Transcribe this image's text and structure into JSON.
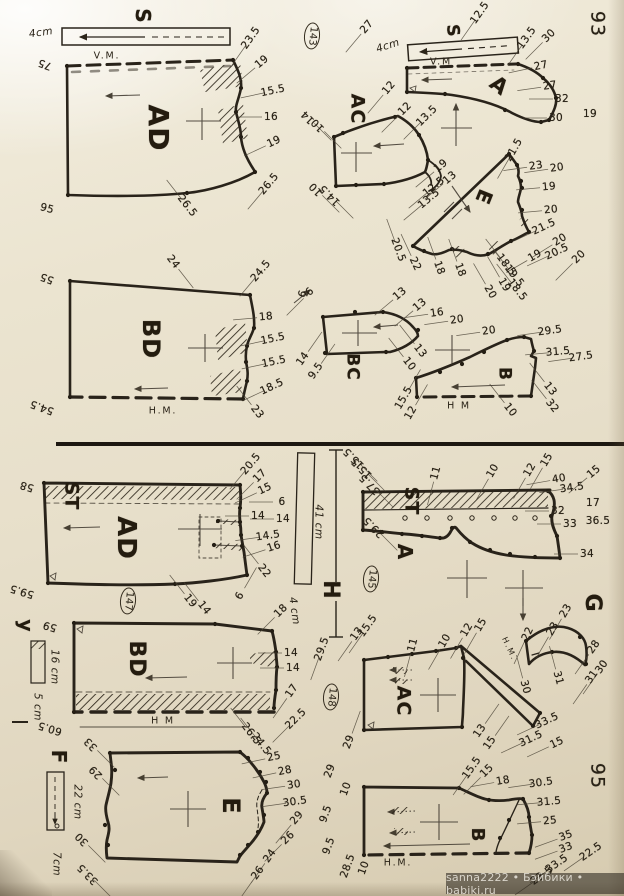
{
  "page": {
    "watermark": "sanna2222 • Бэйбики • babiki.ru",
    "ink_color": "#29231a",
    "paper_color": "#e9e2cf"
  },
  "labels": [
    {
      "t": "S",
      "x": 143,
      "y": 16,
      "r": 90,
      "s": 20,
      "c": "big",
      "n": "label-s-left"
    },
    {
      "t": "S",
      "x": 452,
      "y": 31,
      "r": 85,
      "s": 17,
      "c": "big",
      "n": "label-s-right"
    },
    {
      "t": "AD",
      "x": 158,
      "y": 128,
      "r": 90,
      "s": 28,
      "c": "big",
      "n": "piece-ad-top"
    },
    {
      "t": "BD",
      "x": 151,
      "y": 339,
      "r": 90,
      "s": 24,
      "c": "big",
      "n": "piece-bd-top"
    },
    {
      "t": "AC",
      "x": 357,
      "y": 109,
      "r": 90,
      "s": 19,
      "c": "big",
      "n": "piece-ac-top"
    },
    {
      "t": "A",
      "x": 499,
      "y": 86,
      "r": 38,
      "s": 21,
      "c": "big",
      "n": "piece-a-top"
    },
    {
      "t": "E",
      "x": 484,
      "y": 197,
      "r": 112,
      "s": 20,
      "c": "big",
      "n": "piece-e-top"
    },
    {
      "t": "BC",
      "x": 352,
      "y": 367,
      "r": 90,
      "s": 17,
      "c": "big",
      "n": "piece-bc"
    },
    {
      "t": "B",
      "x": 504,
      "y": 374,
      "r": 90,
      "s": 17,
      "c": "big",
      "n": "piece-b-top"
    },
    {
      "t": "ST",
      "x": 71,
      "y": 496,
      "r": 90,
      "s": 19,
      "c": "big",
      "n": "label-st-left"
    },
    {
      "t": "AD",
      "x": 126,
      "y": 538,
      "r": 90,
      "s": 26,
      "c": "big",
      "n": "piece-ad-bottom"
    },
    {
      "t": "y",
      "x": 25,
      "y": 626,
      "r": 90,
      "s": 19,
      "c": "big",
      "n": "label-y"
    },
    {
      "t": "BD",
      "x": 136,
      "y": 659,
      "r": 90,
      "s": 22,
      "c": "big",
      "n": "piece-bd-bottom"
    },
    {
      "t": "F",
      "x": 59,
      "y": 757,
      "r": 90,
      "s": 20,
      "c": "big",
      "n": "label-f"
    },
    {
      "t": "E",
      "x": 231,
      "y": 806,
      "r": 90,
      "s": 24,
      "c": "big",
      "n": "piece-e-bottom"
    },
    {
      "t": "ST",
      "x": 411,
      "y": 501,
      "r": 90,
      "s": 19,
      "c": "big",
      "n": "label-st-right"
    },
    {
      "t": "A",
      "x": 405,
      "y": 552,
      "r": 90,
      "s": 20,
      "c": "big",
      "n": "piece-a-bottom"
    },
    {
      "t": "H",
      "x": 330,
      "y": 590,
      "r": 90,
      "s": 22,
      "c": "big",
      "n": "label-h"
    },
    {
      "t": "G",
      "x": 592,
      "y": 603,
      "r": 90,
      "s": 22,
      "c": "big",
      "n": "piece-g"
    },
    {
      "t": "AC",
      "x": 403,
      "y": 701,
      "r": 90,
      "s": 19,
      "c": "big",
      "n": "piece-ac-bottom"
    },
    {
      "t": "B",
      "x": 477,
      "y": 835,
      "r": 90,
      "s": 18,
      "c": "big",
      "n": "piece-b-bottom"
    },
    {
      "t": "93",
      "x": 597,
      "y": 24,
      "r": 90,
      "c": "page",
      "n": "page-number-93"
    },
    {
      "t": "95",
      "x": 597,
      "y": 776,
      "r": 90,
      "c": "page",
      "n": "page-number-95"
    },
    {
      "t": "143",
      "x": 312,
      "y": 36,
      "r": 95,
      "c": "circ",
      "n": "pattern-number-143"
    },
    {
      "t": "145",
      "x": 371,
      "y": 579,
      "r": 95,
      "c": "circ",
      "n": "pattern-number-145"
    },
    {
      "t": "147",
      "x": 128,
      "y": 601,
      "r": 95,
      "c": "circ",
      "n": "pattern-number-147"
    },
    {
      "t": "148",
      "x": 331,
      "y": 697,
      "r": 95,
      "c": "circ",
      "n": "pattern-number-148"
    },
    {
      "t": "4cm",
      "x": 41,
      "y": 33,
      "r": -8,
      "c": "cm",
      "n": "scale-4cm-left"
    },
    {
      "t": "4cm",
      "x": 388,
      "y": 46,
      "r": -18,
      "c": "cm",
      "n": "scale-4cm-right"
    },
    {
      "t": "41 cm",
      "x": 318,
      "y": 522,
      "r": 90,
      "c": "cm",
      "n": "scale-41cm"
    },
    {
      "t": "4 cm",
      "x": 294,
      "y": 611,
      "r": 82,
      "c": "cm",
      "n": "scale-4cm-bottom"
    },
    {
      "t": "16 cm",
      "x": 54,
      "y": 667,
      "r": 90,
      "c": "cm",
      "n": "scale-16cm"
    },
    {
      "t": "5 cm",
      "x": 37,
      "y": 707,
      "r": 90,
      "c": "cm",
      "n": "scale-5cm"
    },
    {
      "t": "22 cm",
      "x": 77,
      "y": 802,
      "r": 90,
      "c": "cm",
      "n": "scale-22cm"
    },
    {
      "t": "7cm",
      "x": 56,
      "y": 864,
      "r": 90,
      "c": "cm",
      "n": "scale-7cm"
    },
    {
      "t": "V.M.",
      "x": 107,
      "y": 56,
      "c": "vm",
      "n": "fold-line-vm-left"
    },
    {
      "t": "V.M",
      "x": 441,
      "y": 62,
      "c": "vm",
      "n": "fold-line-vm-right"
    },
    {
      "t": "H.M.",
      "x": 163,
      "y": 411,
      "c": "vm",
      "n": "fold-line-hm-1"
    },
    {
      "t": "H M",
      "x": 459,
      "y": 406,
      "c": "vm",
      "n": "fold-line-hm-2"
    },
    {
      "t": "H M",
      "x": 163,
      "y": 721,
      "c": "vm",
      "n": "fold-line-hm-3"
    },
    {
      "t": "H.M.",
      "x": 398,
      "y": 863,
      "c": "vm",
      "n": "fold-line-hm-4"
    },
    {
      "t": "H.M.",
      "x": 509,
      "y": 649,
      "r": 65,
      "s": 8,
      "c": "vm",
      "n": "fold-line-hm-g"
    },
    {
      "t": "23.5",
      "x": 251,
      "y": 38,
      "r": -55
    },
    {
      "t": "19",
      "x": 262,
      "y": 62,
      "r": -40
    },
    {
      "t": "15.5",
      "x": 273,
      "y": 91,
      "r": -12
    },
    {
      "t": "16",
      "x": 271,
      "y": 117,
      "r": 0
    },
    {
      "t": "19",
      "x": 274,
      "y": 142,
      "r": -25
    },
    {
      "t": "26.5",
      "x": 269,
      "y": 184,
      "r": -50
    },
    {
      "t": "75",
      "x": 45,
      "y": 64,
      "r": 200,
      "d": 0
    },
    {
      "t": "95",
      "x": 47,
      "y": 209,
      "r": 15,
      "d": 0
    },
    {
      "t": "26.5",
      "x": 187,
      "y": 206,
      "r": 52,
      "d": -1
    },
    {
      "t": "24",
      "x": 173,
      "y": 262,
      "r": 52,
      "d": 1
    },
    {
      "t": "55",
      "x": 47,
      "y": 278,
      "r": 200,
      "d": 0
    },
    {
      "t": "24.5",
      "x": 261,
      "y": 271,
      "r": -50
    },
    {
      "t": "18",
      "x": 266,
      "y": 317,
      "r": -5
    },
    {
      "t": "15.5",
      "x": 273,
      "y": 339,
      "r": -12
    },
    {
      "t": "15.5",
      "x": 274,
      "y": 362,
      "r": -12
    },
    {
      "t": "18.5",
      "x": 272,
      "y": 387,
      "r": -25
    },
    {
      "t": "23",
      "x": 257,
      "y": 412,
      "r": 52,
      "d": -1
    },
    {
      "t": "54.5",
      "x": 42,
      "y": 407,
      "r": 200,
      "d": 0
    },
    {
      "t": "6",
      "x": 303,
      "y": 294,
      "r": -70,
      "d": 0
    },
    {
      "t": "12.5",
      "x": 480,
      "y": 13,
      "r": -55
    },
    {
      "t": "27",
      "x": 367,
      "y": 27,
      "r": -50
    },
    {
      "t": "13.5",
      "x": 527,
      "y": 38,
      "r": -55
    },
    {
      "t": "30",
      "x": 549,
      "y": 36,
      "r": -45
    },
    {
      "t": "12",
      "x": 389,
      "y": 88,
      "r": -50
    },
    {
      "t": "27",
      "x": 541,
      "y": 66,
      "r": -12
    },
    {
      "t": "27",
      "x": 550,
      "y": 86,
      "r": -8
    },
    {
      "t": "32",
      "x": 562,
      "y": 99,
      "r": 0
    },
    {
      "t": "30",
      "x": 556,
      "y": 118,
      "r": 0
    },
    {
      "t": "19",
      "x": 590,
      "y": 114,
      "r": 0,
      "d": 0
    },
    {
      "t": "12",
      "x": 405,
      "y": 109,
      "r": -45
    },
    {
      "t": "13.5",
      "x": 427,
      "y": 116,
      "r": -45
    },
    {
      "t": "14",
      "x": 308,
      "y": 117,
      "r": 225,
      "d": -1
    },
    {
      "t": "10",
      "x": 318,
      "y": 125,
      "r": 225,
      "d": -1
    },
    {
      "t": "10",
      "x": 316,
      "y": 189,
      "r": 225,
      "d": -1
    },
    {
      "t": "14.5",
      "x": 330,
      "y": 195,
      "r": 225,
      "d": -1
    },
    {
      "t": "19",
      "x": 441,
      "y": 166,
      "r": -40
    },
    {
      "t": "13",
      "x": 450,
      "y": 178,
      "r": -40
    },
    {
      "t": "12.5",
      "x": 434,
      "y": 187,
      "r": -40
    },
    {
      "t": "13.5",
      "x": 429,
      "y": 199,
      "r": -40
    },
    {
      "t": "21.5",
      "x": 514,
      "y": 150,
      "r": -60
    },
    {
      "t": "23",
      "x": 536,
      "y": 166,
      "r": -8
    },
    {
      "t": "20",
      "x": 557,
      "y": 168,
      "r": -8
    },
    {
      "t": "19",
      "x": 549,
      "y": 187,
      "r": -5
    },
    {
      "t": "20",
      "x": 551,
      "y": 210,
      "r": -5
    },
    {
      "t": "21.5",
      "x": 544,
      "y": 227,
      "r": -25
    },
    {
      "t": "20",
      "x": 560,
      "y": 240,
      "r": -32
    },
    {
      "t": "20.5",
      "x": 557,
      "y": 252,
      "r": -25
    },
    {
      "t": "20",
      "x": 579,
      "y": 257,
      "r": -45
    },
    {
      "t": "19",
      "x": 535,
      "y": 256,
      "r": -30
    },
    {
      "t": "18.5",
      "x": 506,
      "y": 265,
      "r": 52,
      "d": -1
    },
    {
      "t": "19.5",
      "x": 514,
      "y": 276,
      "r": 52,
      "d": -1
    },
    {
      "t": "18.5",
      "x": 517,
      "y": 290,
      "r": 52,
      "d": -1
    },
    {
      "t": "19",
      "x": 504,
      "y": 285,
      "r": 60,
      "d": -1
    },
    {
      "t": "20",
      "x": 490,
      "y": 292,
      "r": 60,
      "d": -1
    },
    {
      "t": "18",
      "x": 460,
      "y": 270,
      "r": 70,
      "d": -1
    },
    {
      "t": "18",
      "x": 439,
      "y": 268,
      "r": 70,
      "d": -1
    },
    {
      "t": "22",
      "x": 415,
      "y": 264,
      "r": 65,
      "d": -1
    },
    {
      "t": "20.5",
      "x": 398,
      "y": 250,
      "r": 70,
      "d": -1
    },
    {
      "t": "6",
      "x": 310,
      "y": 292,
      "r": -45
    },
    {
      "t": "13",
      "x": 400,
      "y": 294,
      "r": -40
    },
    {
      "t": "13",
      "x": 420,
      "y": 305,
      "r": -40
    },
    {
      "t": "16",
      "x": 437,
      "y": 313,
      "r": -8
    },
    {
      "t": "20",
      "x": 457,
      "y": 320,
      "r": -8
    },
    {
      "t": "13",
      "x": 420,
      "y": 351,
      "r": 52,
      "d": -1
    },
    {
      "t": "10",
      "x": 409,
      "y": 364,
      "r": 52,
      "d": -1
    },
    {
      "t": "14",
      "x": 303,
      "y": 359,
      "r": -55,
      "d": 1
    },
    {
      "t": "9.5",
      "x": 316,
      "y": 371,
      "r": -55,
      "d": 1
    },
    {
      "t": "20",
      "x": 489,
      "y": 331,
      "r": -8
    },
    {
      "t": "29.5",
      "x": 550,
      "y": 331,
      "r": -8
    },
    {
      "t": "31.5",
      "x": 558,
      "y": 352,
      "r": -5
    },
    {
      "t": "27.5",
      "x": 581,
      "y": 357,
      "r": -8
    },
    {
      "t": "13",
      "x": 550,
      "y": 389,
      "r": 52,
      "d": -1
    },
    {
      "t": "32",
      "x": 552,
      "y": 406,
      "r": 52,
      "d": -1
    },
    {
      "t": "10",
      "x": 510,
      "y": 410,
      "r": 52,
      "d": -1
    },
    {
      "t": "15.5",
      "x": 404,
      "y": 398,
      "r": -60,
      "d": 1
    },
    {
      "t": "12",
      "x": 411,
      "y": 413,
      "r": -60,
      "d": 1
    },
    {
      "t": "20.5",
      "x": 251,
      "y": 464,
      "r": -50
    },
    {
      "t": "17",
      "x": 260,
      "y": 476,
      "r": -45
    },
    {
      "t": "15",
      "x": 265,
      "y": 489,
      "r": -25
    },
    {
      "t": "6",
      "x": 282,
      "y": 502,
      "r": 0
    },
    {
      "t": "14",
      "x": 258,
      "y": 516,
      "r": 0
    },
    {
      "t": "14",
      "x": 283,
      "y": 519,
      "r": 0
    },
    {
      "t": "14.5",
      "x": 268,
      "y": 536,
      "r": -8
    },
    {
      "t": "16",
      "x": 274,
      "y": 547,
      "r": -18
    },
    {
      "t": "22",
      "x": 264,
      "y": 571,
      "r": 52,
      "d": -1
    },
    {
      "t": "58",
      "x": 27,
      "y": 486,
      "r": 197,
      "d": 0
    },
    {
      "t": "59.5",
      "x": 22,
      "y": 591,
      "r": 197,
      "d": 0
    },
    {
      "t": "19",
      "x": 190,
      "y": 601,
      "r": 52,
      "d": -1
    },
    {
      "t": "14",
      "x": 204,
      "y": 608,
      "r": 52,
      "d": -1
    },
    {
      "t": "6",
      "x": 240,
      "y": 596,
      "r": -60,
      "d": 1
    },
    {
      "t": "18",
      "x": 281,
      "y": 611,
      "r": -45
    },
    {
      "t": "14",
      "x": 291,
      "y": 653,
      "r": 0
    },
    {
      "t": "14",
      "x": 293,
      "y": 668,
      "r": 0
    },
    {
      "t": "17",
      "x": 292,
      "y": 691,
      "r": -55
    },
    {
      "t": "22.5",
      "x": 296,
      "y": 719,
      "r": -45
    },
    {
      "t": "26.5",
      "x": 251,
      "y": 734,
      "r": 52,
      "d": -1
    },
    {
      "t": "24.5",
      "x": 261,
      "y": 744,
      "r": 52,
      "d": -1
    },
    {
      "t": "59",
      "x": 50,
      "y": 626,
      "r": 197,
      "d": 0
    },
    {
      "t": "60.5",
      "x": 50,
      "y": 728,
      "r": 197,
      "d": 0
    },
    {
      "t": "33",
      "x": 91,
      "y": 744,
      "r": 225,
      "d": -1
    },
    {
      "t": "29",
      "x": 96,
      "y": 772,
      "r": 225,
      "d": -1
    },
    {
      "t": "30",
      "x": 82,
      "y": 839,
      "r": 225,
      "d": -1
    },
    {
      "t": "33.5",
      "x": 88,
      "y": 874,
      "r": 225,
      "d": -1
    },
    {
      "t": "25",
      "x": 274,
      "y": 757,
      "r": -12
    },
    {
      "t": "28",
      "x": 285,
      "y": 771,
      "r": -12
    },
    {
      "t": "30",
      "x": 294,
      "y": 785,
      "r": -8
    },
    {
      "t": "30.5",
      "x": 295,
      "y": 802,
      "r": -8
    },
    {
      "t": "29",
      "x": 297,
      "y": 818,
      "r": -50
    },
    {
      "t": "26",
      "x": 288,
      "y": 838,
      "r": -45
    },
    {
      "t": "24",
      "x": 270,
      "y": 856,
      "r": -55
    },
    {
      "t": "26",
      "x": 258,
      "y": 873,
      "r": -55
    },
    {
      "t": "15.5",
      "x": 354,
      "y": 458,
      "r": 225,
      "d": -1
    },
    {
      "t": "15.5",
      "x": 362,
      "y": 468,
      "r": 225,
      "d": -1
    },
    {
      "t": "37.5",
      "x": 370,
      "y": 484,
      "r": 225,
      "d": -1
    },
    {
      "t": "29.5",
      "x": 374,
      "y": 527,
      "r": 225,
      "d": -1
    },
    {
      "t": "11",
      "x": 436,
      "y": 473,
      "r": -75
    },
    {
      "t": "10",
      "x": 493,
      "y": 471,
      "r": -60
    },
    {
      "t": "12",
      "x": 530,
      "y": 470,
      "r": -60
    },
    {
      "t": "15",
      "x": 547,
      "y": 460,
      "r": -60
    },
    {
      "t": "15",
      "x": 594,
      "y": 472,
      "r": -40
    },
    {
      "t": "40",
      "x": 559,
      "y": 479,
      "r": -10
    },
    {
      "t": "34.5",
      "x": 572,
      "y": 488,
      "r": -8
    },
    {
      "t": "32",
      "x": 558,
      "y": 511,
      "r": 0
    },
    {
      "t": "33",
      "x": 570,
      "y": 524,
      "r": 0
    },
    {
      "t": "17",
      "x": 593,
      "y": 503,
      "r": 0,
      "d": 0
    },
    {
      "t": "36.5",
      "x": 598,
      "y": 521,
      "r": 0,
      "d": 0
    },
    {
      "t": "34",
      "x": 587,
      "y": 554,
      "r": 0
    },
    {
      "t": "23",
      "x": 566,
      "y": 611,
      "r": -60
    },
    {
      "t": "23",
      "x": 553,
      "y": 629,
      "r": -60
    },
    {
      "t": "22",
      "x": 528,
      "y": 634,
      "r": -65
    },
    {
      "t": "28",
      "x": 594,
      "y": 647,
      "r": -55
    },
    {
      "t": "30",
      "x": 602,
      "y": 667,
      "r": -55
    },
    {
      "t": "31",
      "x": 592,
      "y": 677,
      "r": -55
    },
    {
      "t": "31",
      "x": 558,
      "y": 678,
      "r": 75,
      "d": -1
    },
    {
      "t": "30",
      "x": 525,
      "y": 687,
      "r": 75,
      "d": -1
    },
    {
      "t": "29.5",
      "x": 322,
      "y": 649,
      "r": -70
    },
    {
      "t": "15.5",
      "x": 368,
      "y": 626,
      "r": -55
    },
    {
      "t": "13",
      "x": 357,
      "y": 634,
      "r": -55
    },
    {
      "t": "11",
      "x": 413,
      "y": 645,
      "r": -75
    },
    {
      "t": "10",
      "x": 445,
      "y": 641,
      "r": -60
    },
    {
      "t": "12",
      "x": 467,
      "y": 630,
      "r": -60
    },
    {
      "t": "15",
      "x": 481,
      "y": 625,
      "r": -60
    },
    {
      "t": "29",
      "x": 349,
      "y": 742,
      "r": -70,
      "d": 1
    },
    {
      "t": "33.5",
      "x": 547,
      "y": 721,
      "r": -25
    },
    {
      "t": "31.5",
      "x": 531,
      "y": 739,
      "r": -25
    },
    {
      "t": "15",
      "x": 557,
      "y": 743,
      "r": -25
    },
    {
      "t": "13",
      "x": 480,
      "y": 731,
      "r": -55,
      "d": 1
    },
    {
      "t": "15",
      "x": 490,
      "y": 743,
      "r": -55,
      "d": 1
    },
    {
      "t": "29",
      "x": 330,
      "y": 771,
      "r": -70,
      "d": 0
    },
    {
      "t": "10",
      "x": 346,
      "y": 789,
      "r": -70,
      "d": 0
    },
    {
      "t": "9.5",
      "x": 326,
      "y": 814,
      "r": -70,
      "d": 0
    },
    {
      "t": "9.5",
      "x": 329,
      "y": 846,
      "r": -70,
      "d": 0
    },
    {
      "t": "28.5",
      "x": 348,
      "y": 866,
      "r": -70,
      "d": 0
    },
    {
      "t": "10",
      "x": 364,
      "y": 868,
      "r": -70,
      "d": 0
    },
    {
      "t": "15.5",
      "x": 472,
      "y": 768,
      "r": -55
    },
    {
      "t": "15",
      "x": 487,
      "y": 771,
      "r": -45
    },
    {
      "t": "18",
      "x": 503,
      "y": 781,
      "r": -10
    },
    {
      "t": "30.5",
      "x": 541,
      "y": 783,
      "r": -8
    },
    {
      "t": "31.5",
      "x": 549,
      "y": 802,
      "r": -5
    },
    {
      "t": "25",
      "x": 550,
      "y": 821,
      "r": -5
    },
    {
      "t": "35",
      "x": 566,
      "y": 836,
      "r": -20
    },
    {
      "t": "33",
      "x": 566,
      "y": 848,
      "r": -20
    },
    {
      "t": "22.5",
      "x": 591,
      "y": 852,
      "r": -35
    },
    {
      "t": "33.5",
      "x": 557,
      "y": 864,
      "r": -35
    },
    {
      "t": "23.5",
      "x": 542,
      "y": 876,
      "r": -35
    }
  ]
}
